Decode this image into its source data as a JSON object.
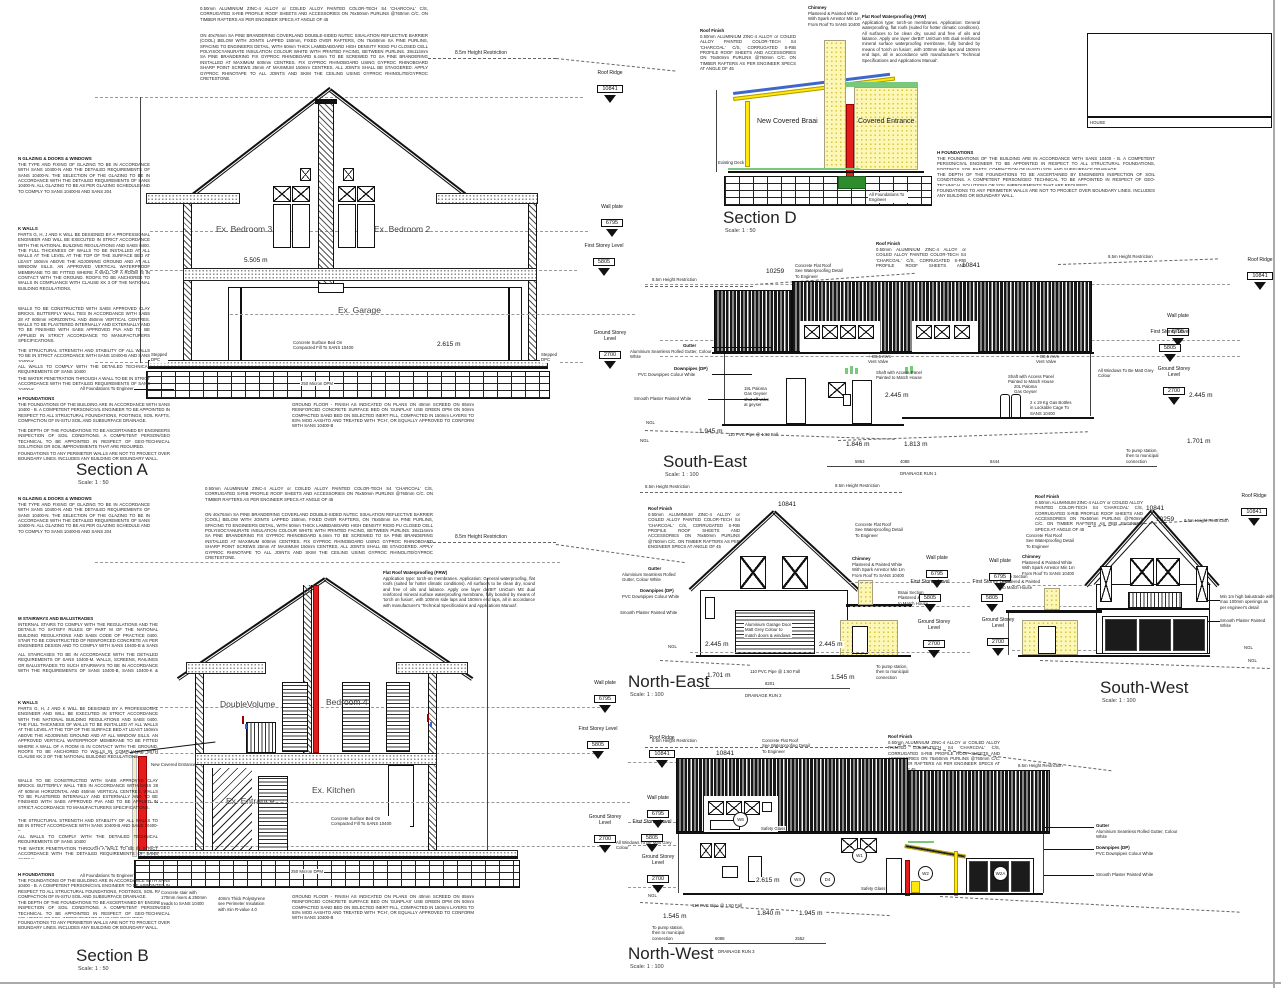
{
  "sheet": {
    "titleblock_label": "HOUSE"
  },
  "levels": {
    "roof_ridge": {
      "label": "Roof Ridge",
      "value": "10841"
    },
    "wall_plate": {
      "label": "Wall plate",
      "value": "6795"
    },
    "first_storey": {
      "label": "First Storey Level",
      "value": "5805"
    },
    "ground_storey": {
      "label": "Ground Storey\nLevel",
      "value": "2700"
    }
  },
  "common": {
    "height_restriction": "8.5m Height Restriction",
    "ngl": "NGL",
    "pvc_pipe": "110 PVC Pipe @ 1:60 Fall",
    "pump_station": "To pump station,\nthen to municipal\nconnection",
    "foundations_engineer": "All Foundations To Engineer",
    "gutter_title": "Gutter",
    "gutter_body": "Aluminium Seamless Rolled Gutter, Colour White",
    "downpipes_title": "Downpipes (DP)",
    "downpipes_body": "PVC Downpipes Colour White",
    "smooth_plaster": "Smooth Plaster Painted White",
    "windows_grey": "All Windows To Be Matt Grey Colour",
    "concrete_flat_roof": "Concrete Flat Roof\nSee Waterproofing Detail\nTo Engineer",
    "chimney_title": "Chimney",
    "chimney_body": "Plastered & Painted White\nWith Spark Arrestor Min 1m\nFrom Roof To SANS 10400",
    "braai_note": "Braai Section\nPlastered & Painted\nto Match House",
    "roof_finish_title": "Roof Finish",
    "roof_finish_body": "0.50mm ALUMINIUM ZINC-4 ALLOY or COILED ALLOY PAINTED COLOR-TECH S4 'CHARCOAL' C/S, CORRUGATED S-RIB PROFILE ROOF SHEETS AND ACCESSORIES ON 76x50mm PURLINS @760mm C/C. ON TIMBER RAFTERS AS PER ENGINEER SPECS AT ANGLE OF 45",
    "elev_10841": "10841",
    "elev_10259": "10259",
    "shaft_note": "Shaft with Access Panel\nPainted to Match House",
    "vent_valve": "+ O0,5 mVs\nVent Valve",
    "safety_glass": "Safety Glass",
    "stepped_dpc": "Stepped\nDPC",
    "dpm": "250 Micron DPM",
    "existing_deck": "Existing Deck"
  },
  "specs": {
    "glazing_title": "N GLAZING & DOORS & WINDOWS",
    "glazing_body": "THE TYPE AND FIXING OF GLAZING TO BE IN ACCORDANCE WITH SANS 10400-N AND THE DETAILED REQUIREMENTS OF SANS 10400-N. THE SELECTION OF THE GLAZING TO BE IN ACCORDANCE WITH THE DETAILED REQUIREMENTS OF SANS 10400-N. ALL GLAZING TO BE AS PER GLAZING SCHEDULE AND TO COMPLY TO SANS 10400-B AND SANS 204",
    "walls_title": "K WALLS",
    "walls_body": "PARTS G, H, J AND K WILL BE DESIGNED BY A PROFESSIONAL ENGINEER AND WILL BE EXECUTED IN STRICT ACCORDANCE WITH THE NATIONAL BUILDING REGULATIONS AND SABS 0400. THE FULL THICKNESS OF WALLS TO BE INSTALLED AT ALL WALLS AT THE LEVEL AT THE TOP OF THE SURFACE BED AT LEAST 150mm ABOVE THE ADJOINING GROUND AND AT ALL WINDOW SILLS. AN APPROVED VERTICAL WATERPROOF MEMBRANE TO BE FITTED WHERE A WALL OF A ROOM IS IN CONTACT WITH THE GROUND. ROOFS TO BE ANCHORED TO WALLS IN COMPLIANCE WITH CLAUSE KK 3 OF THE NATIONAL BUILDING REGULATIONS.",
    "walls_brick": "WALLS TO BE CONSTRUCTED WITH SABS APPROVED CLAY BRICKS. BUTTERFLY WALL TIES IN ACCORDANCE WITH SABS 28 AT 600mm HORIZONTAL AND 450mm VERTICAL CENTRES. WALLS TO BE PLASTERED INTERNALLY AND EXTERNALLY AND TO BE FINISHED WITH SABS APPROVED PVA AND TO BE APPLIED IN STRICT ACCORDANCE TO MANUFACTURERS SPECIFICATIONS.",
    "walls_strength": "THE STRUCTURAL STRENGTH AND STABILITY OF ALL WALLS TO BE IN STRICT ACCORDANCE WITH SANS 10400-B AND SANS 10400-K",
    "walls_comply": "ALL WALLS TO COMPLY WITH THE DETAILED TECHNICAL REQUIREMENTS OF SANS 10400",
    "walls_water": "THE WATER PENETRATION THROUGH A WALL TO BE IN STRICT ACCORDANCE WITH THE DETAILED REQUIREMENTS OF SANS 10400-K",
    "found_title": "H FOUNDATIONS",
    "found_body": "THE FOUNDATIONS OF THE BUILDING ARE IN ACCORDANCE WITH SANS 10400 - B. A COMPETENT PERSON/CIVIL ENGINEER TO BE APPOINTED IN RESPECT TO ALL STRUCTURAL FOUNDATIONS, FOOTINGS, SOIL RAFTS, COMPACTION OF IN-SITU SOIL AND SUBSURFACE DRAINAGE.",
    "found_depth": "THE DEPTH OF THE FOUNDATIONS TO BE ASCERTAINED BY ENGINEERS INSPECTION OF SOIL CONDITIONS. A COMPETENT PERSON/GEO TECHNICAL TO BE APPOINTED IN RESPECT OF GEO-TECHNICAL SOLUTIONS OR SOIL IMPROVEMENTS THAT ARE REQUIRED.",
    "found_perimeter": "FOUNDATIONS TO ANY PERIMETER WALLS ARE NOT TO PROJECT OVER BOUNDARY LINES. INCLUDES ANY BUILDING OR BOUNDARY WALL.",
    "stairs_title": "M STAIRWAYS AND BALUSTRADES",
    "stairs_body": "INTERNAL STAIRS TO COMPLY WITH THE REGULATIONS AND THE DETAILS TO SATISFY RULES OF PART M OF THE NATIONAL BUILDING REGULATIONS AND SABS CODE OF PRACTICE 0400. STAIR TO BE CONSTRUCTED OF REINFORCED CONCRETE AS PER ENGINEERS DESIGN AND TO COMPLY WITH SANS 10400-B & SANS 10400-M",
    "stairs_body2": "ALL STAIRCASES TO BE IN ACCORDANCE WITH THE DETAILED REQUIREMENTS OF SANS 10400-M. WALLS, SCREENS, RAILINGS OR BALUSTRADES TO SUCH STAIRWAYS TO BE IN ACCORDANCE WITH THE REQUIREMENTS OF SANS 10400-B, SANS 10400-K & SANS 10400-M.",
    "sisalation": "ON 40x76mm SA PINE BRANDERING COVERLAND DOUBLE-SIDED NUTEC SISALATION REFLECTIVE BARRIER (COOL) BELOW WITH JOINTS LAPPED 150mm, FIXED OVER RAFTERS, ON 76x50mm SA PINE PURLINS, SPACING TO ENGINEERS DETAIL, WITH 50mm THICK LAMBDABOARD HIGH DENSITY RIGID PU CLOSED CELL POLYISOCYANURATE INSULATION COLOUR WHITE WITH PRINTED FACING, BETWEEN PURLINS. 38x114mm SA PINE BRANDERING FIX GYPROC RHINOBOARD 6.4mm TO BE SCREWED TO SA PINE BRANDERING INSTALLED AT MAXIMUM 600mm CENTRES. FIX GYPROC RHINOBOARD USING GYPROC RHINOBOARD SHARP POINT SCREWS 25mm AT MAXIMUM 150mm CENTRES. ALL JOINTS SHALL BE STAGGERED. APPLY GYPROC RHINOTAPE TO ALL JOINTS AND SKIM THE CEILING USING GYPROC RHINOLITE/GYPROC CRETESTONE.",
    "frw_title": "Flat Roof Waterproofing (FRW)",
    "frw_body": "Application type: torch-on membranes. Application: General waterproofing, flat roofs (suited for hotter climatic conditions). All surfaces to be clean dry, sound and free of oils and laitance. Apply one layer derBIT UniGum MS dual reinforced mineral surface waterproofing membrane, fully bonded by means of 'torch on fusion', with 100mm side laps and 150mm end laps, all in accordance with manufacturer's 'Technical Specifications and Applications Manual'.",
    "ground_floor": "GROUND FLOOR - FINISH AS INDICATED ON PLANS ON 40mm SCREED ON 85mm REINFORCED CONCRETE SURFACE BED ON 'GUNPLAS' USB GREEN DPM ON 50mm COMPACTED SAND BED ON SELECTED INERT FILL, COMPACTED IN 150mm LAYERS TO 93% MOD AASHTO AND TREATED WITH 'PCH', OR EQUALLY APPROVED TO CONFORM WITH SANS 10400-B",
    "polystyrene": "40mm Thick Polystyrene\nsee Perimeter Insulation\nwith min R-value 4.0",
    "concrete_bed": "Concrete Surface Bed On\nCompacted Fill To SANS 10400",
    "stair_note": "Concrete stair with\n170mm risers & 250mm\ntreads to SANS 10400"
  },
  "section_a": {
    "title": "Section A",
    "scale": "Scale: 1 : 50",
    "bedroom3": "Ex. Bedroom 3",
    "bedroom2": "Ex. Bedroom 2",
    "garage": "Ex. Garage",
    "dim_5505": "5.505 m",
    "dim_2615": "2.615 m"
  },
  "section_b": {
    "title": "Section B",
    "scale": "Scale: 1 : 50",
    "double_volume": "DoubleVolume",
    "bedroom4": "Bedroom 4",
    "kitchen": "Ex. Kitchen",
    "entrance": "Ex. Entrance",
    "new_covered_entrance": "New Covered Entrance"
  },
  "section_d": {
    "title": "Section D",
    "scale": "Scale: 1 : 50",
    "braai": "New Covered Braai",
    "entrance": "Covered Entrance"
  },
  "south_east": {
    "title": "South-East",
    "scale": "Scale: 1 : 100",
    "d1": "1.945 m",
    "d2": "1.846 m",
    "d3": "1.813 m",
    "d4": "1.701 m",
    "d5": "2.445 m",
    "d6": "2.445 m",
    "geyser19": "19L Paloma\nGas Geyser\nshut off valve\nat geyser",
    "geyser20": "20L Paloma\nGas Geyser",
    "gas_bottles": "2 x 19 Kg Gas Bottles\nin Lockable Cage To\nSANS 10400",
    "run_label": "DRAINAGE RUN 1",
    "run_dims": [
      "5863",
      "4088",
      "8444"
    ]
  },
  "north_east": {
    "title": "North-East",
    "scale": "Scale: 1 : 100",
    "garage_door": "Aluminium Garage Door\nMatt Grey Colour to\nmatch doors & windows",
    "dim_l": "2.445 m",
    "dim_r": "2.445 m",
    "g1": "1.701 m",
    "g2": "1.545 m",
    "run_label": "DRAINAGE RUN 2",
    "run_dim": "8201"
  },
  "south_west": {
    "title": "South-West",
    "scale": "Scale: 1 : 100",
    "balustrade": "Min 1m high balustrade with\nmax 100mm openings as\nper engineer's detail"
  },
  "north_west": {
    "title": "North-West",
    "scale": "Scale: 1 : 100",
    "d1": "1.545 m",
    "d2": "1.840 m",
    "d3": "1.945 m",
    "d4": "2.615 m",
    "run_label": "DRAINAGE RUN 3",
    "run_dims": [
      "6088",
      "2552"
    ],
    "window_marks": [
      "W6",
      "W1",
      "W4",
      "D4",
      "W2",
      "W2A"
    ]
  }
}
